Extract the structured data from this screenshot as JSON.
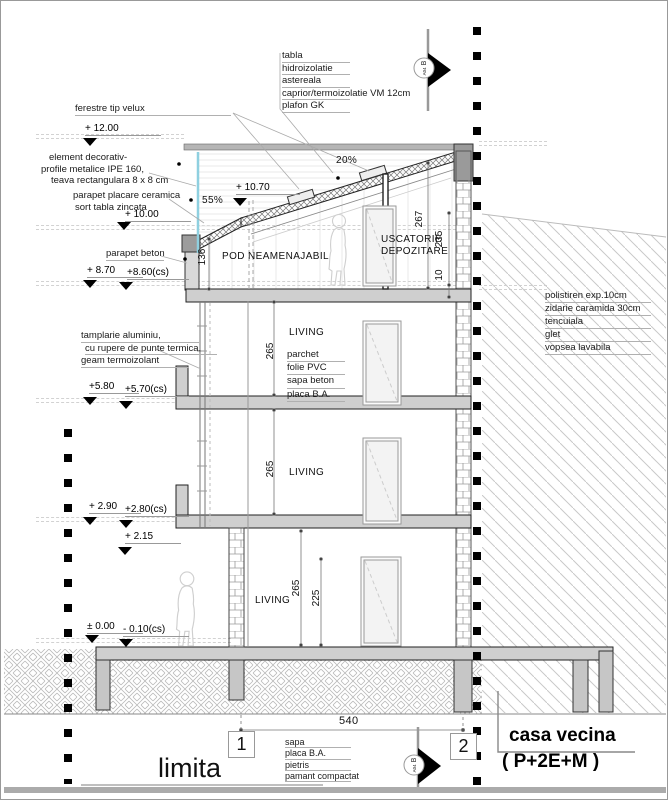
{
  "labels": {
    "limita": "limita",
    "neighbor_line1": "casa vecina",
    "neighbor_line2": "( P+2E+M )"
  },
  "marker": {
    "sheet": "A04",
    "letter": "B"
  },
  "grid": {
    "axis_left": "1",
    "axis_right": "2",
    "span_dim": "540"
  },
  "slopes": {
    "low": "55%",
    "high": "20%"
  },
  "callouts": {
    "velux": "ferestre tip velux",
    "roof_layers": [
      "tabla",
      "hidroizolatie",
      "astereala",
      "caprior/termoizolatie VM 12cm",
      "plafon GK"
    ],
    "decor": [
      "element decorativ-",
      "profile metalice IPE 160,",
      "teava rectangulara 8 x 8 cm"
    ],
    "parapet_ceramic": [
      "parapet placare ceramica",
      "sort tabla zincata"
    ],
    "parapet_beton": "parapet beton",
    "window_frames": [
      "tamplarie aluminiu,",
      "cu rupere de punte termica,",
      "geam termoizolant"
    ],
    "wall_layers": [
      "polistiren exp.10cm",
      "zidarie caramida 30cm",
      "tencuiala",
      "glet",
      "vopsea lavabila"
    ],
    "floor_layers": [
      "parchet",
      "folie PVC",
      "sapa beton",
      "placa B.A."
    ],
    "foundation_layers": [
      "sapa",
      "placa B.A.",
      "pietris",
      "pamant compactat"
    ]
  },
  "levels": {
    "l1200": "+ 12.00",
    "l1070": "+ 10.70",
    "l1000": "+ 10.00",
    "l870": "+ 8.70",
    "l860": "+8.60(cs)",
    "l580": "+5.80",
    "l570": "+5.70(cs)",
    "l290": "+ 2.90",
    "l280": "+2.80(cs)",
    "l215": "+ 2.15",
    "l000": "± 0.00",
    "l010": "- 0.10(cs)"
  },
  "rooms": {
    "attic": "POD NEAMENAJABIL",
    "dryer1": "USCATORIE",
    "dryer2": "DEPOZITARE",
    "living": "LIVING"
  },
  "dims": {
    "attic_left": "136",
    "attic_h1": "267",
    "attic_h2": "235",
    "attic_gap": "10",
    "floor_h": "265",
    "ground_h2": "225"
  }
}
